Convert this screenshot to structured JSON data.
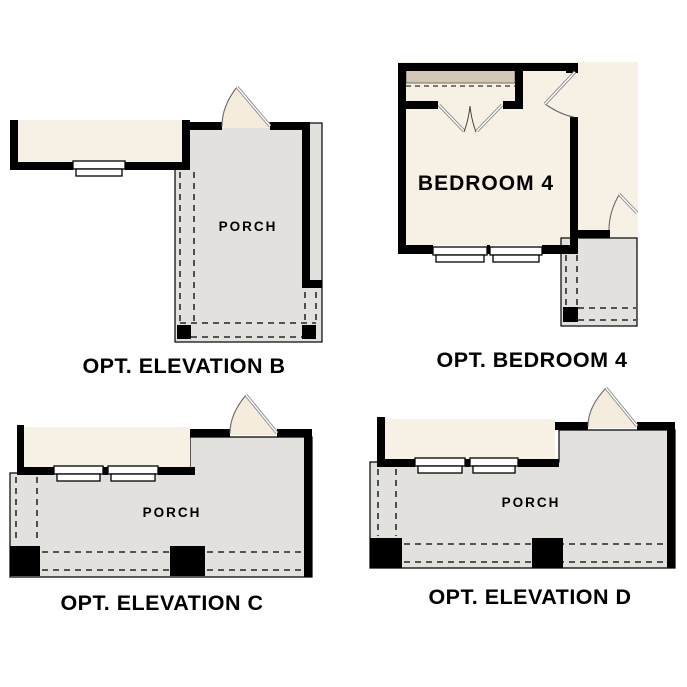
{
  "colors": {
    "background": "#ffffff",
    "wall": "#000000",
    "interior_fill": "#f7f0e4",
    "porch_fill": "#e2e1de",
    "closet_shelf_fill": "#d2c8b5",
    "door_fill": "#f5ecdd",
    "door_leaf_stroke": "#8a8a8a",
    "outline_stroke": "#000000",
    "text_color": "#000000"
  },
  "plans": {
    "elevation_b": {
      "title": "OPT. ELEVATION B",
      "room_label": "PORCH"
    },
    "bedroom_4": {
      "title": "OPT. BEDROOM 4",
      "room_label": "BEDROOM 4"
    },
    "elevation_c": {
      "title": "OPT. ELEVATION C",
      "room_label": "PORCH"
    },
    "elevation_d": {
      "title": "OPT. ELEVATION D",
      "room_label": "PORCH"
    }
  }
}
